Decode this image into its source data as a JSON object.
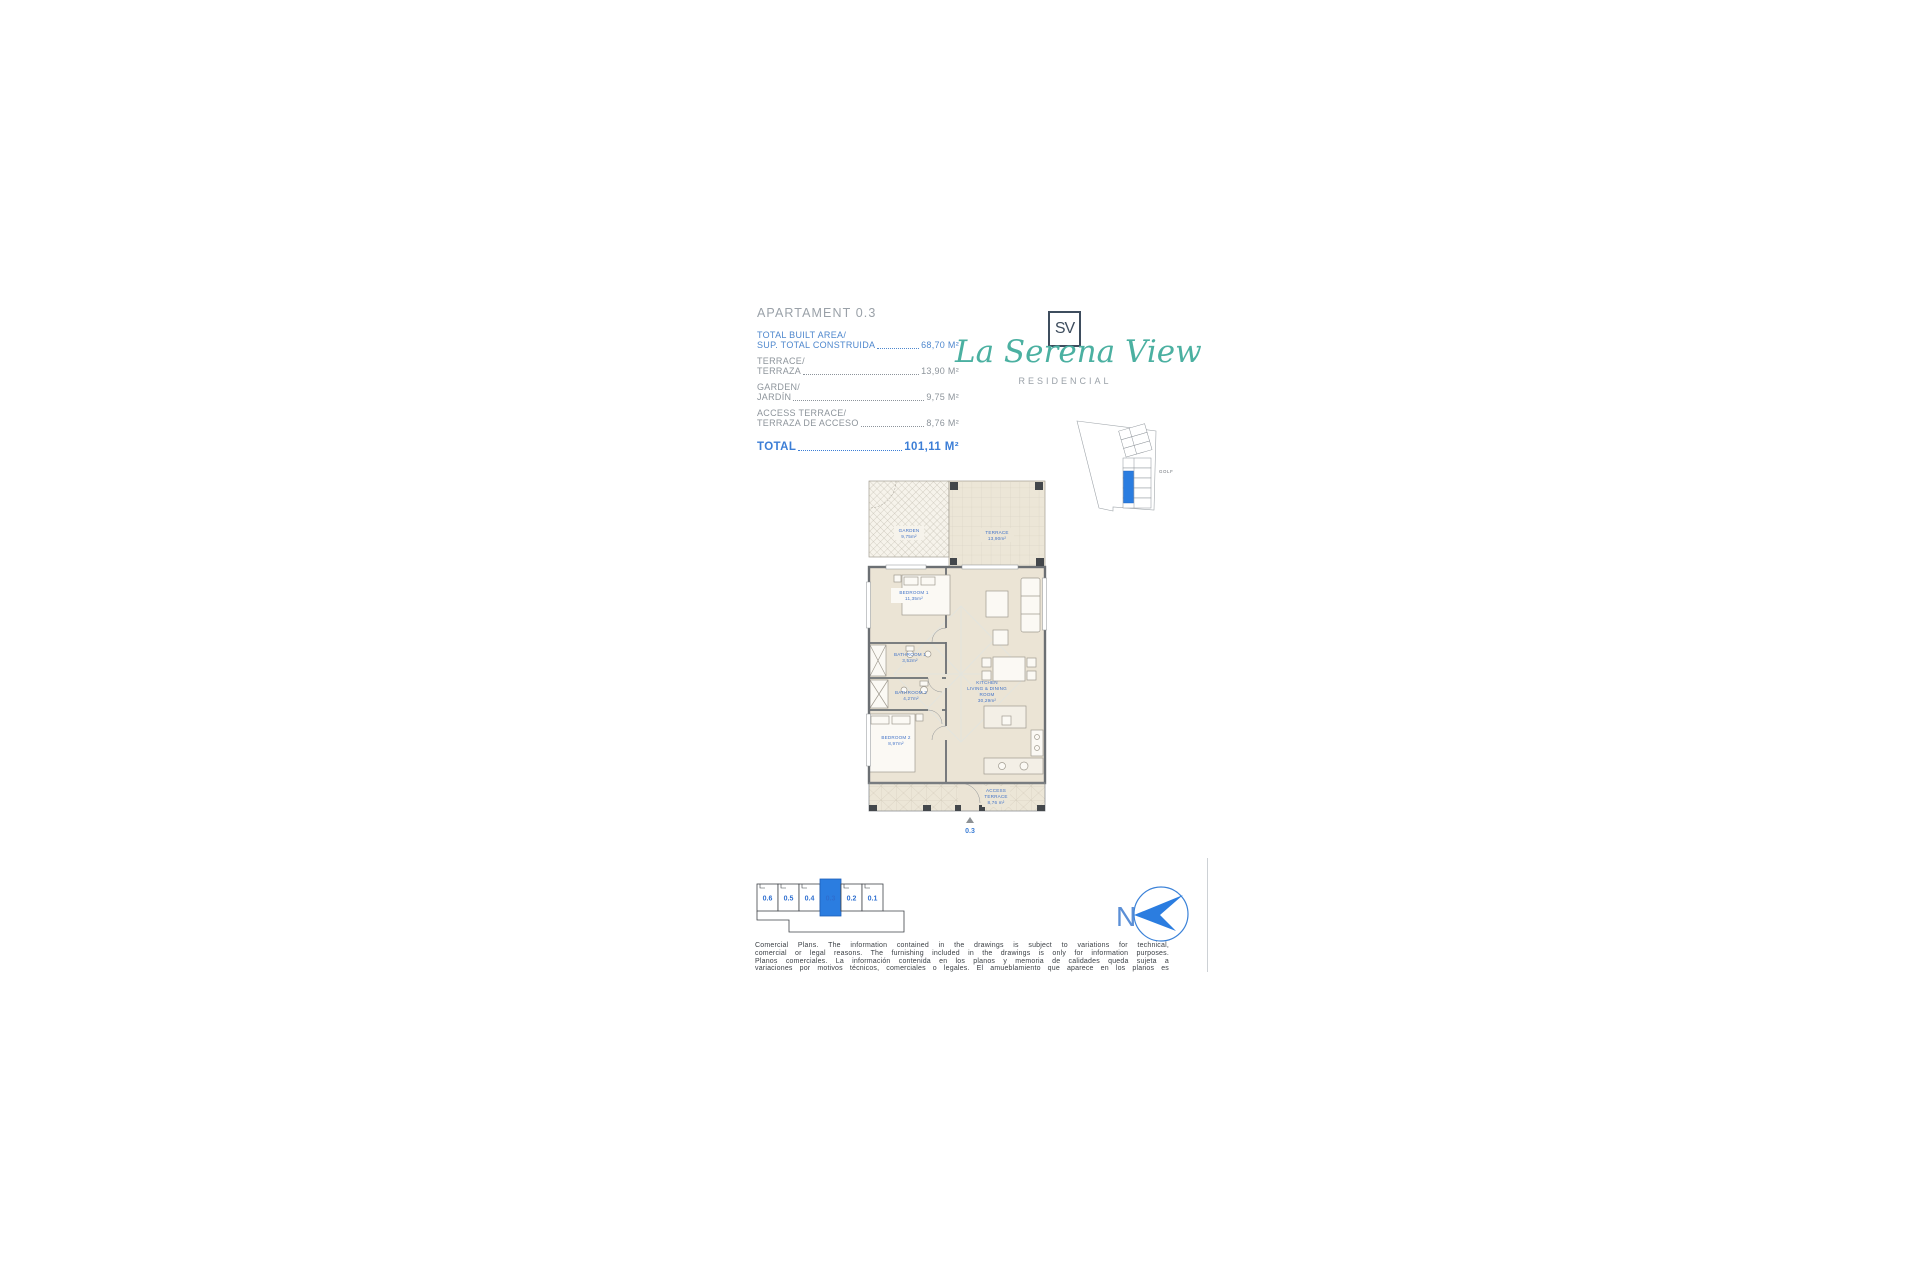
{
  "page": {
    "title": "APARTAMENT 0.3"
  },
  "areas": {
    "rows": [
      {
        "label_en": "TOTAL BUILT AREA/",
        "label_es": "SUP. TOTAL CONSTRUIDA",
        "value": "68,70 M²"
      },
      {
        "label_en": "TERRACE/",
        "label_es": "TERRAZA",
        "value": "13,90 M²"
      },
      {
        "label_en": "GARDEN/",
        "label_es": "JARDÍN",
        "value": "9,75 M²"
      },
      {
        "label_en": "ACCESS TERRACE/",
        "label_es": "TERRAZA DE ACCESO",
        "value": "8,76 M²"
      }
    ],
    "total_label": "TOTAL",
    "total_value": "101,11 M²"
  },
  "logo": {
    "monogram": "SV",
    "brand": "La Serena View",
    "subtitle": "RESIDENCIAL"
  },
  "site_plan": {
    "golf_label": "GOLF"
  },
  "floor_plan": {
    "rooms": {
      "garden": {
        "name": "GARDEN",
        "area": "9,75m²"
      },
      "terrace": {
        "name": "TERRACE",
        "area": "13,90m²"
      },
      "bedroom1": {
        "name": "BEDROOM 1",
        "area": "11,35m²"
      },
      "bathroom1": {
        "name": "BATHROOM 1",
        "area": "3,52m²"
      },
      "bathroom2": {
        "name": "BATHROOM 2",
        "area": "4,27m²"
      },
      "bedroom2": {
        "name": "BEDROOM 2",
        "area": "8,97m²"
      },
      "kitchen": {
        "line1": "KITCHEN",
        "line2": "LIVING & DINING",
        "line3": "ROOM",
        "area": "30,29m²"
      },
      "access_terrace": {
        "line1": "ACCESS",
        "line2": "TERRACE",
        "area": "8,76 m²"
      }
    },
    "unit_marker": "0.3"
  },
  "key_plan": {
    "units": [
      "0.6",
      "0.5",
      "0.4",
      "0.3",
      "0.2",
      "0.1"
    ],
    "selected": "0.3"
  },
  "compass": {
    "label": "N"
  },
  "disclaimer": {
    "lines": [
      "Comercial Plans. The information contained in the drawings is subject to variations for technical,",
      "comercial or legal reasons. The furnishing included in the drawings is only for information purposes.",
      "Planos comerciales. La información contenida en los planos y memoria de calidades queda sujeta a",
      "variaciones por motivos técnicos, comerciales o legales. El amueblamiento que aparece en los planos es"
    ]
  },
  "colors": {
    "accent_blue": "#2b7de0",
    "text_blue": "#4e87cd",
    "teal": "#4bb0a1",
    "gray": "#8d949b"
  }
}
